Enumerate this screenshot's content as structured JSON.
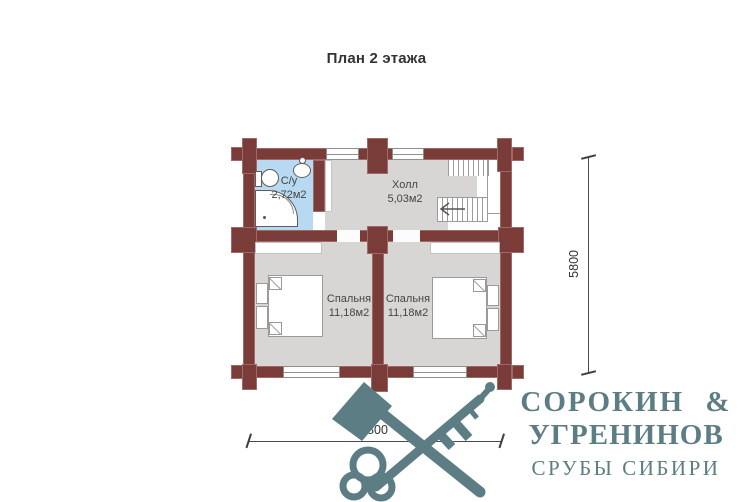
{
  "title": "План 2 этажа",
  "rooms": {
    "bathroom": {
      "name": "С/у",
      "area": "2,72м2"
    },
    "hall": {
      "name": "Холл",
      "area": "5,03м2"
    },
    "bedroom_left": {
      "name": "Спальня",
      "area": "11,18м2"
    },
    "bedroom_right": {
      "name": "Спальня",
      "area": "11,18м2"
    }
  },
  "dimensions": {
    "height_mm": "5800",
    "width_mm": "6800"
  },
  "logo": {
    "line1": "СОРОКИН &",
    "line2": "УГРЕНИНОВ",
    "line3": "СРУБЫ СИБИРИ"
  },
  "colors": {
    "wall": "#7a3c38",
    "floor": "#d7d6d4",
    "bathroom_floor": "#b7d9f1",
    "logo_teal": "#5d7d84"
  }
}
